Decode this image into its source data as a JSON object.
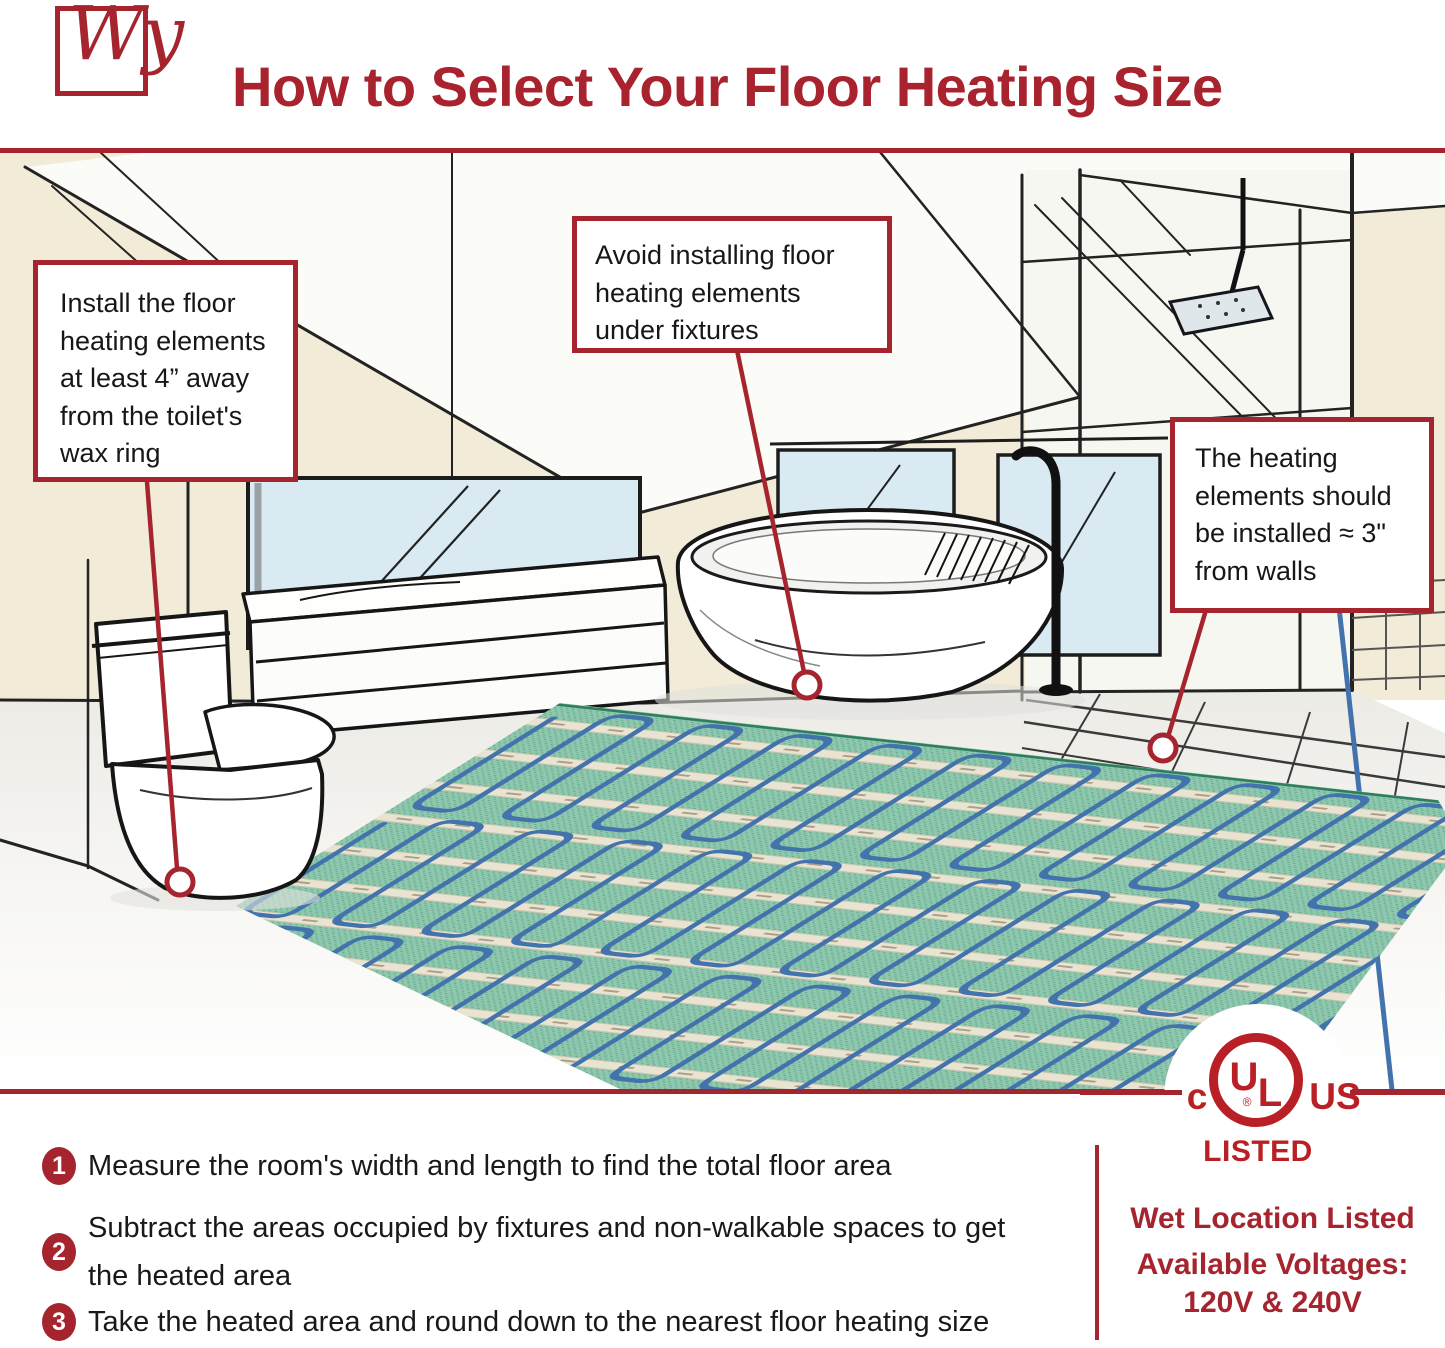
{
  "header": {
    "logo_text": "Wy",
    "title": "How to Select Your Floor Heating Size"
  },
  "callouts": {
    "toilet": "Install the floor heating elements at least 4” away from the toilet's wax ring",
    "fixtures": "Avoid installing floor heating elements under fixtures",
    "walls": "The heating elements should be installed ≈ 3\" from walls"
  },
  "steps": [
    {
      "number": "1",
      "text": "Measure the room's width and length to find the total floor area"
    },
    {
      "number": "2",
      "text": "Subtract the areas occupied by fixtures and non-walkable spaces to get the heated area"
    },
    {
      "number": "3",
      "text": "Take the heated area and round down to the nearest floor heating size"
    }
  ],
  "certification": {
    "ul_c": "c",
    "ul_u": "U",
    "ul_l": "L",
    "ul_us": "US",
    "ul_registered": "®",
    "ul_listed": "LISTED",
    "wet_location": "Wet Location Listed",
    "voltages_label": "Available Voltages:",
    "voltages_value": "120V & 240V"
  },
  "colors": {
    "brand_red": "#A5242E",
    "ul_red": "#B92025",
    "text_dark": "#1A1A1A",
    "wall_cream": "#F1EBD8",
    "window_blue": "#D9EAF3",
    "mat_green": "#8BC6AB",
    "cable_blue": "#4273AC",
    "tape_cream": "#E9E3D2"
  }
}
